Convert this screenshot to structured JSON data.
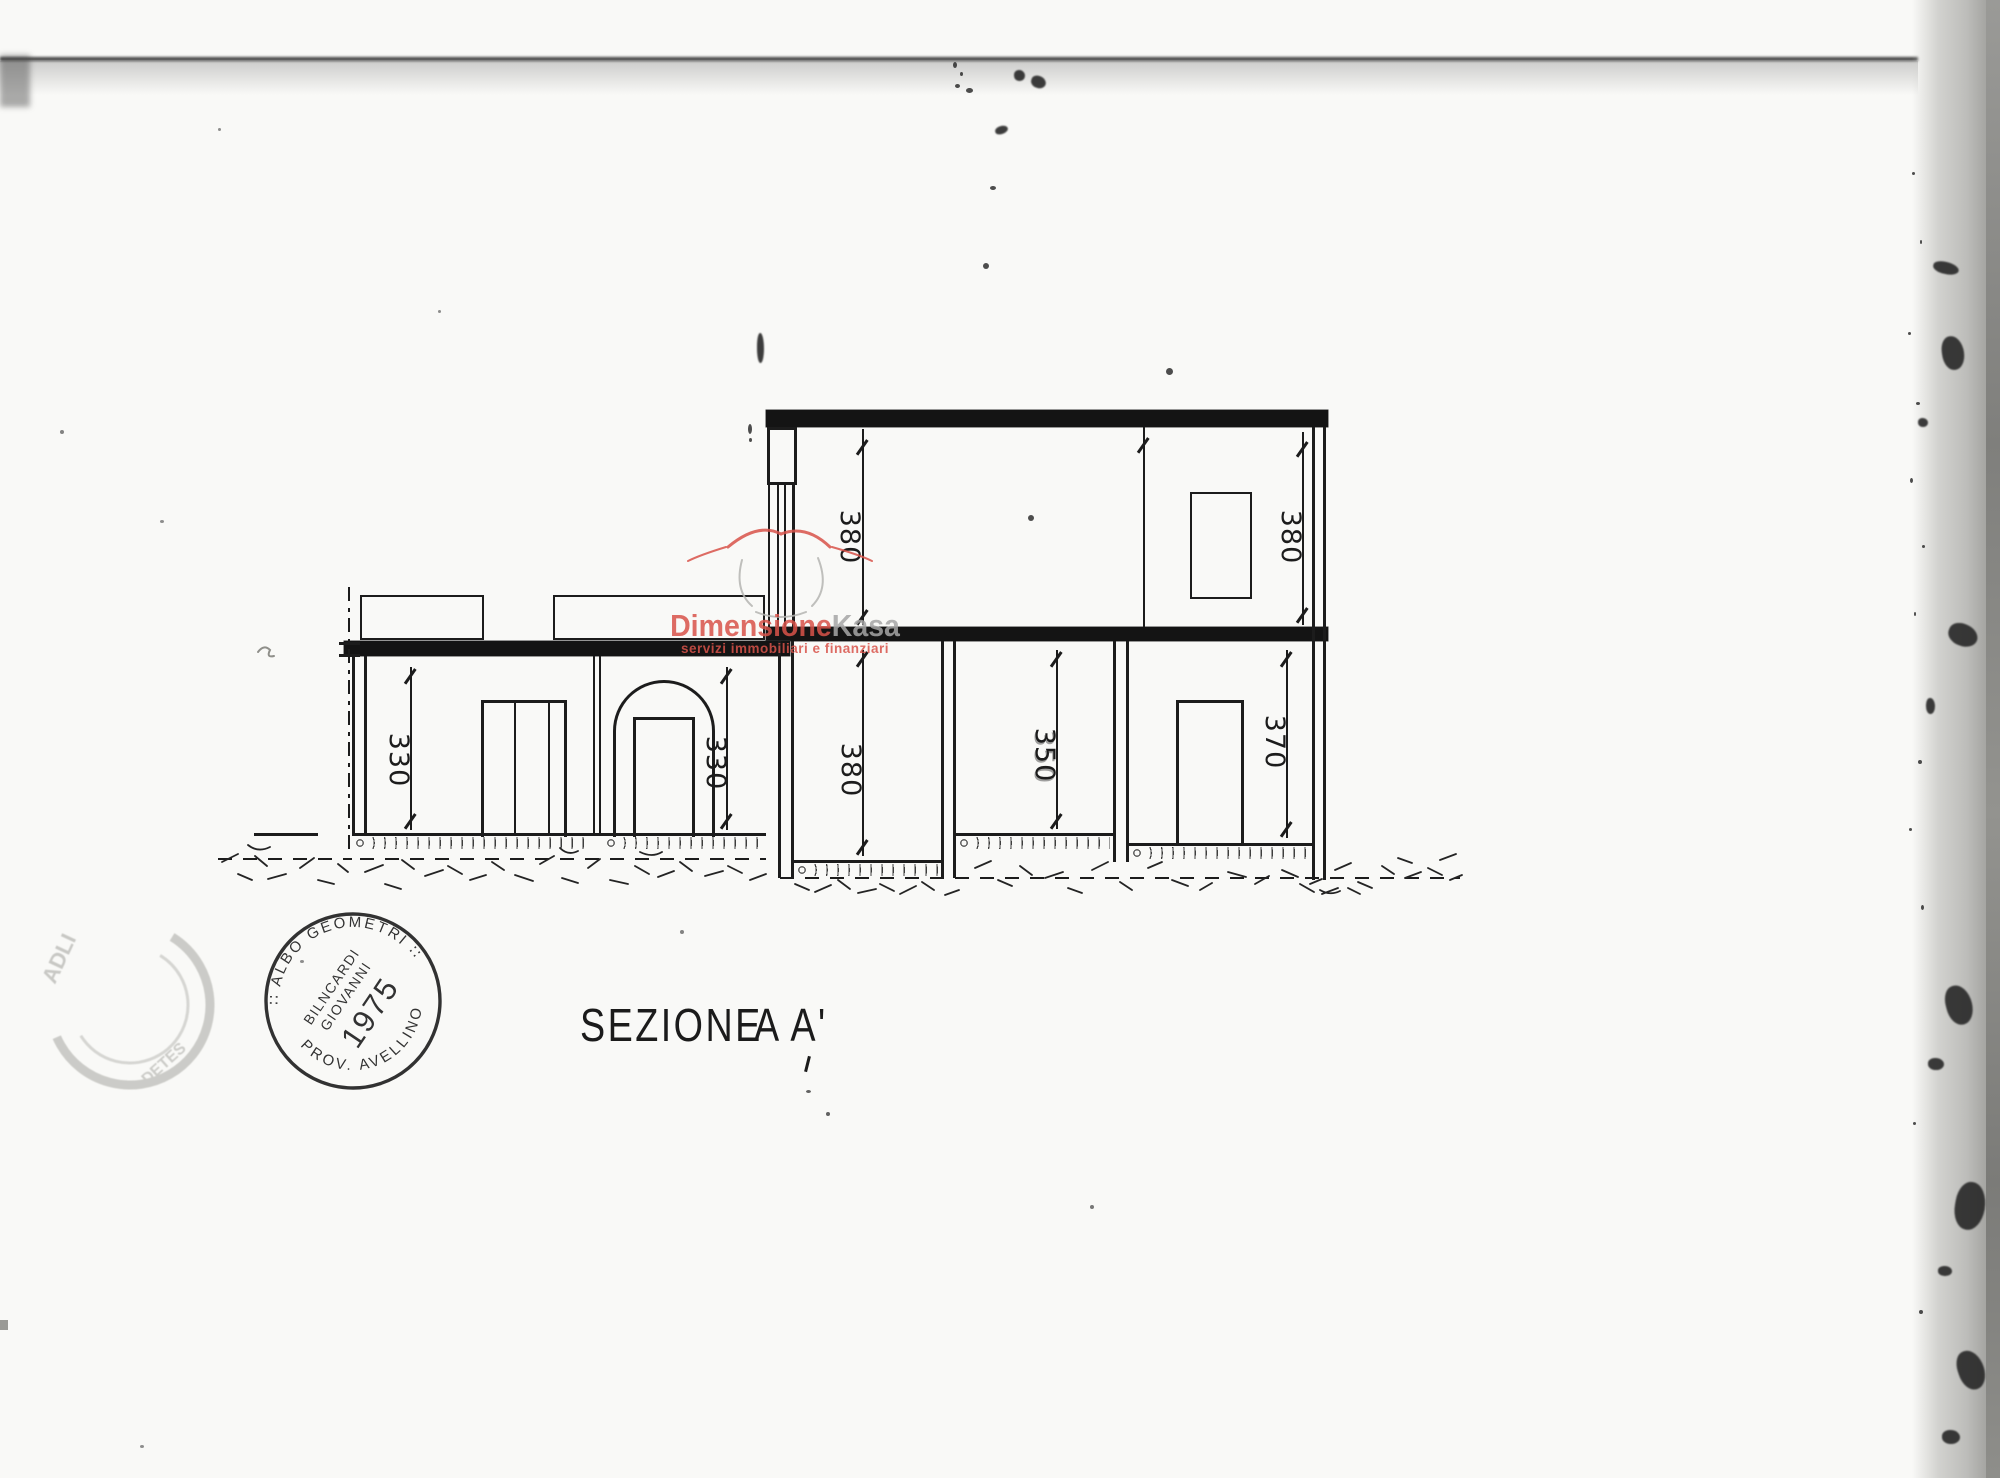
{
  "title": {
    "label": "SEZIONE",
    "suffix": "A A'"
  },
  "drawing": {
    "dimensions": {
      "upper_left": "380",
      "upper_right": "380",
      "left_room_1": "330",
      "left_room_2": "330",
      "lower_room_1": "380",
      "lower_room_2": "350",
      "lower_room_3": "370"
    }
  },
  "watermark": {
    "brand_primary": "Dimensione",
    "brand_secondary": "Kasa",
    "tagline": "servizi immobiliari e finanziari",
    "primary_color": "#d9534a",
    "secondary_color": "#a6a6a6"
  },
  "stamps": {
    "registry": {
      "arc_top": "∷  ALBO  GEOMETRI  ∷",
      "arc_bottom": "PROV.  AVELLINO",
      "line1": "BILNCARDI",
      "line2": "GIOVANNI",
      "year": "1975"
    },
    "faint": {
      "fragment_top": "ADLI",
      "fragment_bottom": "DETES"
    }
  }
}
